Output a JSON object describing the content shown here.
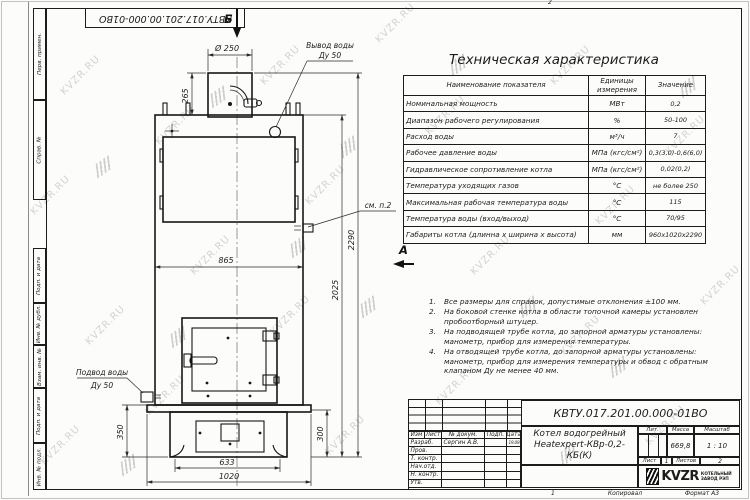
{
  "sheet": {
    "fold_mark_top": "2",
    "fold_mark_bottom": "1",
    "copied_label": "Копировал",
    "format_label": "Формат А3",
    "doc_number_top": "КВТУ.017.201.00.000-01ВО"
  },
  "watermark": {
    "text": "KVZR.RU"
  },
  "margin": {
    "labels": [
      "Перв. примен.",
      "Справ. №",
      "Подп. и дата",
      "Инв. № дубл.",
      "Взам. инв. №",
      "Подп. и дата",
      "Инв. № подл."
    ]
  },
  "spec_table": {
    "title": "Техническая характеристика",
    "headers": [
      "Наименование показателя",
      "Единицы измерения",
      "Значение"
    ],
    "rows": [
      {
        "name": "Номинальная мощность",
        "unit": "МВт",
        "value": "0,2"
      },
      {
        "name": "Диапазон рабочего регулирования",
        "unit": "%",
        "value": "50-100"
      },
      {
        "name": "Расход воды",
        "unit": "м³/ч",
        "value": "7"
      },
      {
        "name": "Рабочее давление воды",
        "unit": "МПа (кгс/см²)",
        "value": "0,3(3,0)-0,6(6,0)"
      },
      {
        "name": "Гидравлическое сопротивление котла",
        "unit": "МПа (кгс/см²)",
        "value": "0,02(0,2)"
      },
      {
        "name": "Температура уходящих газов",
        "unit": "°С",
        "value": "не более 250"
      },
      {
        "name": "Максимальная рабочая температура воды",
        "unit": "°С",
        "value": "115"
      },
      {
        "name": "Температура воды (вход/выход)",
        "unit": "°С",
        "value": "70/95"
      },
      {
        "name": "Габариты котла (длинна х ширина х высота)",
        "unit": "мм",
        "value": "960х1020х2290"
      }
    ]
  },
  "notes": [
    {
      "num": "1.",
      "text": "Все размеры для справок, допустимые отклонения ±100 мм."
    },
    {
      "num": "2.",
      "text": "На боковой стенке котла в области топочной камеры установлен пробоотборный штуцер."
    },
    {
      "num": "3.",
      "text": "На подводящей трубе котла, до запорной арматуры установлены: манометр, прибор для измерения температуры."
    },
    {
      "num": "4.",
      "text": "На отводящей трубе котла, до запорной арматуры установлены: манометр, прибор для измерения температуры и обвод с обратным клапаном Ду не менее 40 мм."
    }
  ],
  "drawing": {
    "section_b": "Б",
    "section_a": "А",
    "labels": {
      "outlet_line1": "Вывод воды",
      "outlet_line2": "Ду 50",
      "inlet_line1": "Подвод воды",
      "inlet_line2": "Ду 50",
      "see_note": "см. п.2"
    },
    "dims": {
      "d250": "Ø 250",
      "h265": "265",
      "w865": "865",
      "h2290": "2290",
      "h2025": "2025",
      "h350": "350",
      "h300": "300",
      "w633": "633",
      "w1020": "1020"
    }
  },
  "title_block": {
    "doc_number": "КВТУ.017.201.00.000-01ВО",
    "product_line1": "Котел водогрейный",
    "product_line2": "Heatexpert-КВр-0,2-КБ(К)",
    "col_headers": [
      "Изм",
      "Лист",
      "№ докум.",
      "Подп.",
      "Дата"
    ],
    "staff": [
      {
        "role": "Разраб.",
        "name": "Сергин А.В.",
        "date": "19.09.24"
      },
      {
        "role": "Пров.",
        "name": "",
        "date": ""
      },
      {
        "role": "Т. контр.",
        "name": "",
        "date": ""
      },
      {
        "role": "Нач.отд.",
        "name": "",
        "date": ""
      },
      {
        "role": "Н. контр.",
        "name": "",
        "date": ""
      },
      {
        "role": "Утв.",
        "name": "",
        "date": ""
      }
    ],
    "lit_label": "Лит.",
    "mass_label": "Масса",
    "scale_label": "Масштаб",
    "mass_value": "669,8",
    "scale_value": "1 : 10",
    "sheet_label": "Лист",
    "sheet_value": "1",
    "sheets_label": "Листов",
    "sheets_value": "2",
    "logo_text": "KVZR",
    "logo_sub1": "КОТЕЛЬНЫЙ",
    "logo_sub2": "ЗАВОД РЭП"
  }
}
